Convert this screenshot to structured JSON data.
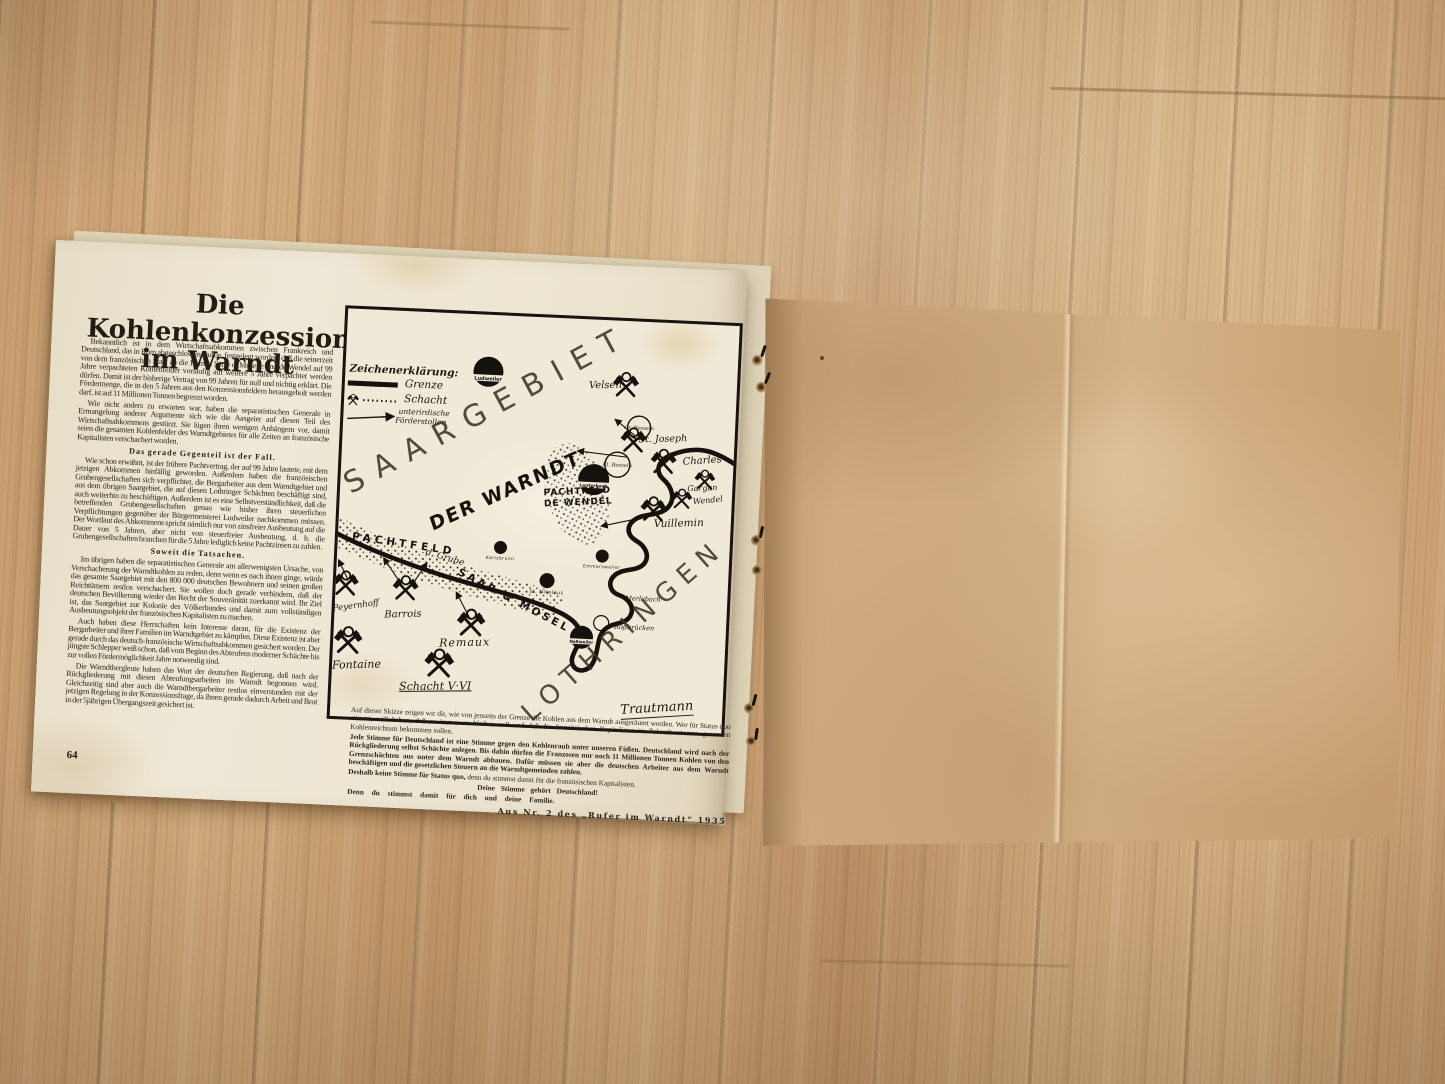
{
  "page": {
    "number": "64",
    "title_line1": "Die Kohlenkonzession",
    "title_line2": "im Warndt",
    "body": {
      "p1": "Bekanntlich ist in dem Wirtschaftsabkommen zwischen Frankreich und Deutschland, das in Rom abgeschlossen wurde, festgelegt worden, daß die seinerzeit von dem französischen Staat an die Firmen Sarre et Moselle und de Wendel auf 99 Jahre verpachteten Kohlenfelder vorläufig auf weitere 5 Jahre verpachtet werden dürfen. Damit ist der bisherige Vertrag von 99 Jahren für null und nichtig erklärt. Die Fördermenge, die in den 5 Jahren aus den Konzessionsfeldern herausgeholt werden darf, ist auf 11 Millionen Tonnen begrenzt worden.",
      "p2": "Wie nicht anders zu erwarten war, haben die separatistischen Generale in Ermangelung anderer Argumente sich wie die Aasgeier auf diesen Teil des Wirtschaftsabkommens gestürzt. Sie lügen ihren wenigen Anhängern vor, damit seien die gesamten Kohlenfelder des Warndtgebietes für alle Zeiten an französische Kapitalisten verschachert worden.",
      "h1": "Das gerade Gegenteil ist der Fall.",
      "p3": "Wie schon erwähnt, ist der frühere Pachtvertrag, der auf 99 Jahre lautete, mit dem jetzigen Abkommen hinfällig geworden. Außerdem haben die französischen Grubengesellschaften sich verpflichtet, die Bergarbeiter aus dem Warndtgebiet und aus dem übrigen Saargebiet, die auf diesen Lothringer Schächten beschäftigt sind, auch weiterhin zu beschäftigen. Außerdem ist es eine Selbstverständlichkeit, daß die betreffenden Grubengesellschaften genau wie bisher ihren steuerlichen Verpflichtungen gegenüber der Bürgermeisterei Ludweiler nachkommen müssen. Der Wortlaut des Abkommens spricht nämlich nur von zinsfreier Ausbeutung auf die Dauer von 5 Jahren, aber nicht von steuerfreier Ausbeutung, d. h. die Grubengesellschaften brauchen für die 5 Jahre lediglich keine Pachtzinsen zu zahlen.",
      "h2": "Soweit die Tatsachen.",
      "p4": "Im übrigen haben die separatistischen Generale am allerwenigsten Ursache, von Verschacherung der Warndtkohlen zu reden, denn wenn es nach ihnen ginge, würde das gesamte Saargebiet mit den 800 000 deutschen Bewohnern und seinen großen Reichtümern restlos verschachert. Sie wollen doch gerade verhindern, daß der deutschen Bevölkerung wieder das Recht der Souveränität zuerkannt wird. Ihr Ziel ist, das Saargebiet zur Kolonie des Völkerbundes und damit zum vollständigen Ausbeutungsobjekt der französischen Kapitalisten zu machen.",
      "p5": "Auch haben diese Herrschaften kein Interesse daran, für die Existenz der Bergarbeiter und ihrer Familien im Warndtgebiet zu kämpfen. Diese Existenz ist aber gerade durch das deutsch-französische Wirtschaftsabkommen gesichert worden. Der jüngste Schlepper weiß schon, daß vom Beginn des Abteufens moderner Schächte bis zur vollen Fördermöglichkeit Jahre notwendig sind.",
      "p6": "Die Warndtbergleute haben das Wort der deutschen Regierung, daß nach der Rückgliederung mit diesen Abteufungsarbeiten im Warndt begonnen wird. Gleichzeitig sind aber auch die Warndtbergarbeiter restlos einverstanden mit der jetzigen Regelung in der Konzessionsfrage, da ihnen gerade dadurch Arbeit und Brot in der 5jährigen Übergangszeit gesichert ist."
    },
    "below_map": {
      "p1": "Auf dieser Skizze zeigen wir dir, wie von jenseits der Grenze die Kohlen aus dem Warndt ausgeräumt werden. Wer für Status quo stimmt, will haben, daß es immer so bleiben soll und daß die französischen Kapitalisten in Zukunft unseren gesamten Kohlenreichtum bekommen sollen.",
      "p2": "Jede Stimme für Deutschland ist eine Stimme gegen den Kohlenraub unter unseren Füßen. Deutschland wird nach der Rückgliederung selbst Schächte anlegen. Bis dahin dürfen die Franzosen nur noch 11 Millionen Tonnen Kohlen von den Grenzschächten aus unter dem Warndt abbauen. Dafür müssen sie aber die deutschen Arbeiter aus dem Warndt beschäftigen und die gesetzlichen Steuern an die Warndtgemeinden zahlen.",
      "p3a": "Deshalb keine Stimme für Status quo,",
      "p3b": " denn du stimmst damit für die französischen Kapitalisten.",
      "p4": "Deine Stimme gehört Deutschland!",
      "p5": "Denn du stimmst damit für dich und deine Familie.",
      "source": "Aus Nr. 2 des „Rufer im Warndt“ 1935"
    }
  },
  "map": {
    "legend": {
      "title": "Zeichenerklärung:",
      "grenze": "Grenze",
      "schacht": "Schacht",
      "stollen1": "unterirdische",
      "stollen2": "Förderstollen"
    },
    "regions": {
      "saargebiet": "SAARGEBIET",
      "warndt": "DER WARNDT",
      "lothringen": "LOTHRINGEN"
    },
    "fields": {
      "pachtfeld": "PACHTFELD",
      "grube": "d. Grube",
      "saar_mosel": "SAAR & MOSEL",
      "wendel1": "PACHTFELD",
      "wendel2": "DE WENDEL"
    },
    "mines": [
      "Velsen",
      "St. Joseph",
      "Charles",
      "Gargan",
      "Wendel",
      "Vuillemin",
      "Peyernhoff",
      "Barrois",
      "Remaux",
      "Fontaine",
      "Schacht V·VI"
    ],
    "towns": [
      "Ludweiler",
      "Lauterbach",
      "Karlsbrunn",
      "Emmersweiler",
      "St. Nikolaus",
      "Naßweiler"
    ],
    "places": [
      "Gr. Rosseln",
      "Kl. Rosseln",
      "Merlebach",
      "Roßbrücken"
    ],
    "signature": "Trautmann"
  }
}
